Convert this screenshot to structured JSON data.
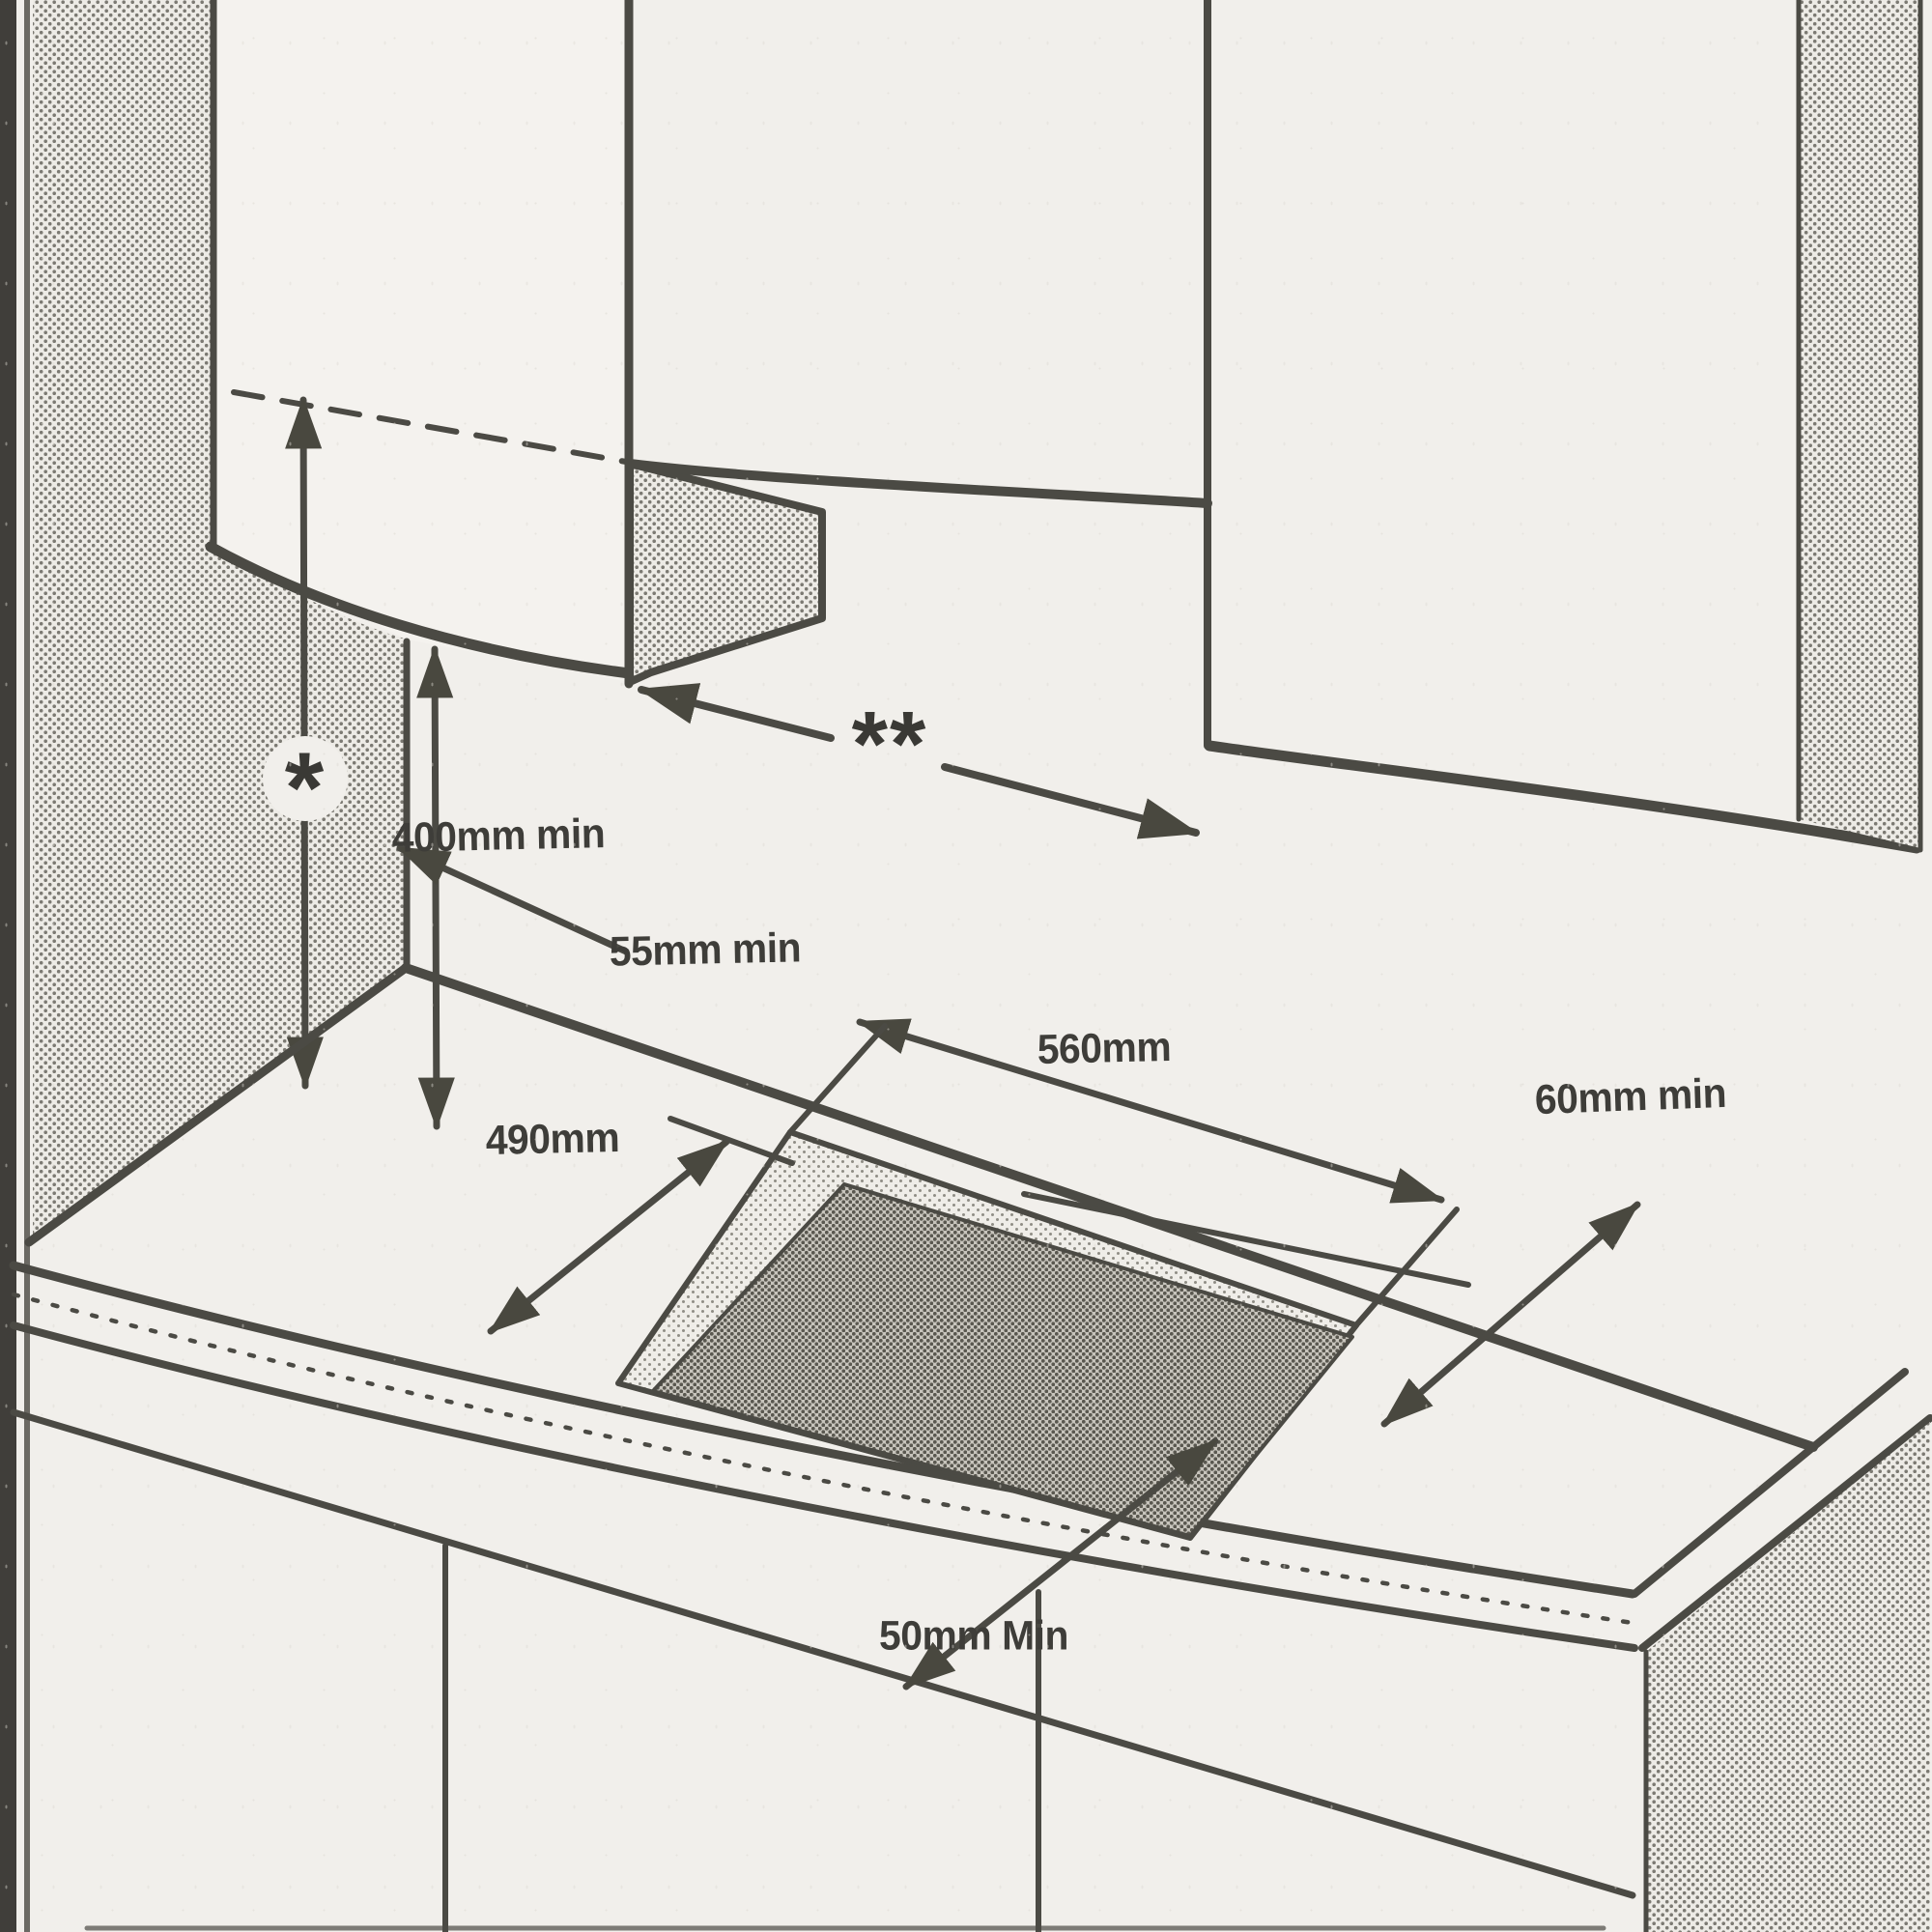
{
  "diagram": {
    "labels": {
      "star_marker": "*",
      "double_star_marker": "**",
      "hood_clearance": "400mm min",
      "rear_clearance": "55mm min",
      "cutout_width": "560mm",
      "cutout_depth": "490mm",
      "side_clearance": "60mm min",
      "front_clearance": "50mm Min"
    }
  }
}
